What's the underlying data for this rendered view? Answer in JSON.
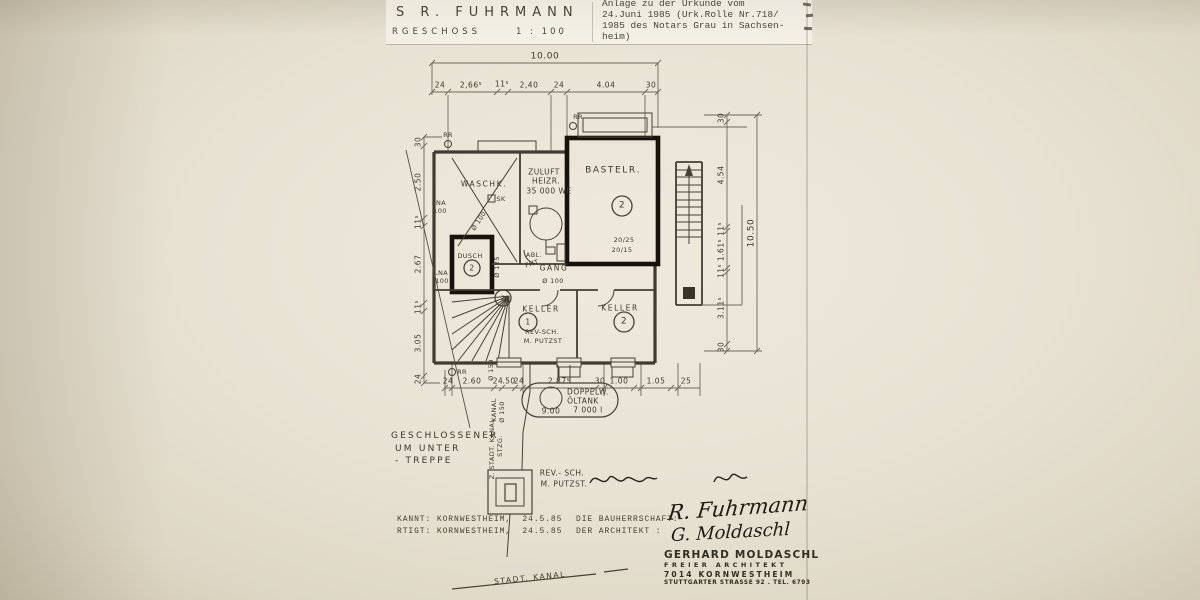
{
  "header": {
    "name": "S  R.  FUHRMANN",
    "floor": "RGESCHOSS",
    "scale": "1 : 100"
  },
  "notary_note": {
    "lines": [
      "Anlage zu der Urkunde vom",
      "24.Juni 1985 (Urk.Rolle Nr.718/",
      "1985 des Notars Grau in Sachsen-",
      "heim)"
    ]
  },
  "footer": {
    "row1_left": "KANNT: KORNWESTHEIM,  24.5.85",
    "row1_right": "DIE BAUHERRSCHAFT:",
    "row2_left": "RTIGT: KORNWESTHEIM,  24.5.85",
    "row2_right": "DER ARCHITEKT :"
  },
  "stamp": {
    "name": "GERHARD MOLDASCHL",
    "title": "FREIER ARCHITEKT",
    "city": "7014 KORNWESTHEIM",
    "address": "STUTTGARTER STRASSE 92 . TEL. 6793"
  },
  "signatures": {
    "sig1": "R. Fuhrmann",
    "sig2": "G. Moldaschl"
  },
  "plan": {
    "labels": [
      {
        "t": "10.00",
        "x": 545,
        "y": 57,
        "c": "s8"
      },
      {
        "t": "24",
        "x": 440,
        "y": 85,
        "c": "s7"
      },
      {
        "t": "2,66⁵",
        "x": 471,
        "y": 85,
        "c": "s7"
      },
      {
        "t": "11⁵",
        "x": 502,
        "y": 84,
        "c": "s7"
      },
      {
        "t": "2,40",
        "x": 529,
        "y": 85,
        "c": "s7"
      },
      {
        "t": "24",
        "x": 559,
        "y": 85,
        "c": "s7"
      },
      {
        "t": "4.04",
        "x": 606,
        "y": 85,
        "c": "s7"
      },
      {
        "t": "30",
        "x": 651,
        "y": 85,
        "c": "s7"
      },
      {
        "t": "30",
        "x": 418,
        "y": 142,
        "c": "s7 rv"
      },
      {
        "t": "2.50",
        "x": 418,
        "y": 182,
        "c": "s7 rv"
      },
      {
        "t": "11⁵",
        "x": 418,
        "y": 222,
        "c": "s7 rv"
      },
      {
        "t": "2.67",
        "x": 418,
        "y": 264,
        "c": "s7 rv"
      },
      {
        "t": "11⁵",
        "x": 418,
        "y": 307,
        "c": "s7 rv"
      },
      {
        "t": "3.05",
        "x": 418,
        "y": 343,
        "c": "s7 rv"
      },
      {
        "t": "24",
        "x": 418,
        "y": 379,
        "c": "s7 rv"
      },
      {
        "t": "30",
        "x": 721,
        "y": 118,
        "c": "s7 rv"
      },
      {
        "t": "4.54",
        "x": 721,
        "y": 175,
        "c": "s7 rv"
      },
      {
        "t": "11⁵",
        "x": 721,
        "y": 229,
        "c": "s7 rv"
      },
      {
        "t": "1.61⁵",
        "x": 721,
        "y": 250,
        "c": "s7 rv"
      },
      {
        "t": "11⁵",
        "x": 721,
        "y": 271,
        "c": "s7 rv"
      },
      {
        "t": "3.11⁵",
        "x": 721,
        "y": 308,
        "c": "s7 rv"
      },
      {
        "t": "30",
        "x": 721,
        "y": 347,
        "c": "s7 rv"
      },
      {
        "t": "10.50",
        "x": 752,
        "y": 233,
        "c": "s8 rv"
      },
      {
        "t": "24",
        "x": 448,
        "y": 381,
        "c": "s7"
      },
      {
        "t": "2.60",
        "x": 472,
        "y": 381,
        "c": "s7"
      },
      {
        "t": "24",
        "x": 498,
        "y": 381,
        "c": "s7"
      },
      {
        "t": ".50",
        "x": 509,
        "y": 381,
        "c": "s7"
      },
      {
        "t": "24",
        "x": 519,
        "y": 381,
        "c": "s7"
      },
      {
        "t": "2.87⁵",
        "x": 559,
        "y": 381,
        "c": "s7"
      },
      {
        "t": "30",
        "x": 600,
        "y": 381,
        "c": "s7"
      },
      {
        "t": "1.00",
        "x": 619,
        "y": 381,
        "c": "s7"
      },
      {
        "t": "1.05",
        "x": 656,
        "y": 381,
        "c": "s7"
      },
      {
        "t": "25",
        "x": 686,
        "y": 381,
        "c": "s7"
      },
      {
        "t": "Ø 150",
        "x": 491,
        "y": 370,
        "c": "s6 rv"
      },
      {
        "t": "KANAL",
        "x": 494,
        "y": 410,
        "c": "s6 rv"
      },
      {
        "t": "Ø 150",
        "x": 502,
        "y": 412,
        "c": "s6 rv"
      },
      {
        "t": "Z. STADT. KANAL",
        "x": 492,
        "y": 449,
        "c": "s6 rv"
      },
      {
        "t": "STZG.",
        "x": 500,
        "y": 446,
        "c": "s6 rv"
      },
      {
        "t": "Ø 100",
        "x": 479,
        "y": 221,
        "c": "s6 rd"
      },
      {
        "t": "Ø 125",
        "x": 497,
        "y": 267,
        "c": "s6 rv"
      },
      {
        "t": "Ø 100",
        "x": 553,
        "y": 281,
        "c": "s6"
      },
      {
        "t": "WASCHK.",
        "x": 484,
        "y": 184,
        "c": "s7 ls1"
      },
      {
        "t": "SK",
        "x": 501,
        "y": 199,
        "c": "s6"
      },
      {
        "t": "ZULUFT",
        "x": 544,
        "y": 172,
        "c": "s7"
      },
      {
        "t": "HEIZR.",
        "x": 546,
        "y": 181,
        "c": "s7"
      },
      {
        "t": "35 000 WE",
        "x": 549,
        "y": 191,
        "c": "s7"
      },
      {
        "t": "BASTELR.",
        "x": 613,
        "y": 171,
        "c": "s8 ls1"
      },
      {
        "t": "2",
        "x": 622,
        "y": 206,
        "c": "s8"
      },
      {
        "t": "20/25",
        "x": 624,
        "y": 240,
        "c": "s6"
      },
      {
        "t": "20/15",
        "x": 622,
        "y": 250,
        "c": "s6"
      },
      {
        "t": "ABL.",
        "x": 534,
        "y": 255,
        "c": "s6"
      },
      {
        "t": "FHT",
        "x": 532,
        "y": 264,
        "c": "s6 r15"
      },
      {
        "t": "GANG",
        "x": 554,
        "y": 268,
        "c": "s7 ls1"
      },
      {
        "t": "DUSCH",
        "x": 470,
        "y": 256,
        "c": "s6"
      },
      {
        "t": "2",
        "x": 472,
        "y": 268,
        "c": "s7"
      },
      {
        "t": "KELLER",
        "x": 541,
        "y": 309,
        "c": "s7 ls1"
      },
      {
        "t": "1",
        "x": 528,
        "y": 322,
        "c": "s7"
      },
      {
        "t": "REV-SCH.",
        "x": 542,
        "y": 332,
        "c": "s6"
      },
      {
        "t": "M. PUTZST",
        "x": 543,
        "y": 341,
        "c": "s6"
      },
      {
        "t": "KELLER",
        "x": 620,
        "y": 308,
        "c": "s7 ls1"
      },
      {
        "t": "2",
        "x": 624,
        "y": 322,
        "c": "s8"
      },
      {
        "t": "2",
        "x": 503,
        "y": 298,
        "c": "s6"
      },
      {
        "t": "LNA",
        "x": 439,
        "y": 203,
        "c": "s6"
      },
      {
        "t": "100",
        "x": 440,
        "y": 211,
        "c": "s6"
      },
      {
        "t": "LNA",
        "x": 441,
        "y": 273,
        "c": "s6"
      },
      {
        "t": "100",
        "x": 442,
        "y": 281,
        "c": "s6"
      },
      {
        "t": "RR",
        "x": 448,
        "y": 135,
        "c": "s6"
      },
      {
        "t": "RR",
        "x": 578,
        "y": 117,
        "c": "s6"
      },
      {
        "t": "RR",
        "x": 462,
        "y": 372,
        "c": "s6"
      },
      {
        "t": "DOPPELW.",
        "x": 588,
        "y": 392,
        "c": "s7"
      },
      {
        "t": "ÖLTANK",
        "x": 583,
        "y": 401,
        "c": "s7"
      },
      {
        "t": "7 000 l",
        "x": 588,
        "y": 410,
        "c": "s7"
      },
      {
        "t": "9.00",
        "x": 551,
        "y": 411,
        "c": "s7"
      },
      {
        "t": "STADT. KANAL",
        "x": 530,
        "y": 578,
        "c": "s7 r5 ls1"
      },
      {
        "t": "GESCHLOSSENER",
        "x": 391,
        "y": 432,
        "c": "s8 ls2 ll"
      },
      {
        "t": "UM UNTER",
        "x": 395,
        "y": 445,
        "c": "s8 ls2 ll"
      },
      {
        "t": "- TREPPE",
        "x": 395,
        "y": 457,
        "c": "s8 ls2 ll"
      },
      {
        "t": "REV.- SCH.",
        "x": 562,
        "y": 473,
        "c": "s7"
      },
      {
        "t": "M. PUTZST.",
        "x": 564,
        "y": 484,
        "c": "s7"
      }
    ]
  }
}
